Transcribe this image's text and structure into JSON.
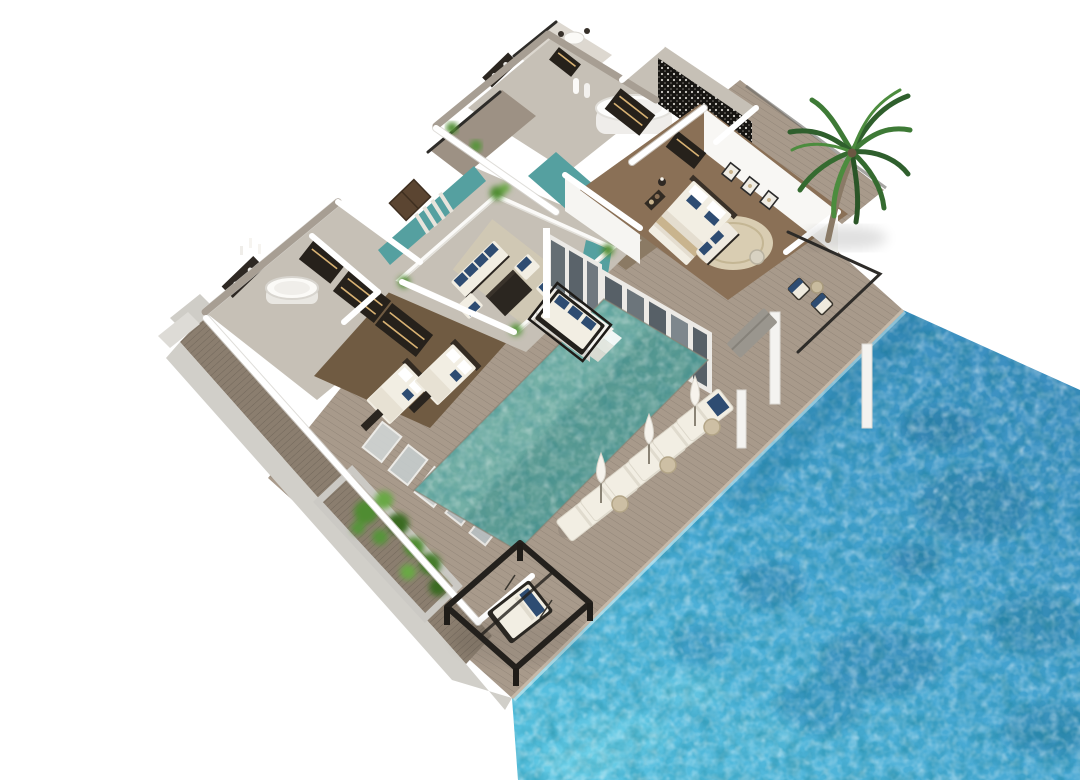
{
  "meta": {
    "image_type": "isometric 3D architectural floor-plan render",
    "subject": "two-storey beachfront villa with courtyard lounge, swimming pool, timber sun deck, cabana and ocean",
    "background": "#ffffff"
  },
  "palette": {
    "ocean_base": "#45a2cf",
    "ocean_deep": "#2e7ba6",
    "ocean_light": "#6fd0e8",
    "pool_base": "#5c9c94",
    "pool_light": "#8cc3b8",
    "moat_water": "#55a0a0",
    "deck_wood": "#a89a8b",
    "walkway_wood": "#8b7e6f",
    "concrete": "#d1cfc9",
    "wall_white": "#ffffff",
    "wall_shade": "#e9e8e4",
    "marble_wall": "#a79e93",
    "marble_floor": "#c6c0b6",
    "guest_floor": "#705b42",
    "master_floor": "#8a7056",
    "dining_floor": "#8b7a64",
    "rug": "#d9cdb2",
    "furniture_white": "#f2eee3",
    "cushion_navy": "#2e4c72",
    "dark_wood": "#26211b",
    "glass": "#4a545c",
    "metal_black": "#201d19",
    "palm_green": "#2f5f2d",
    "palm_light": "#4c8c3e",
    "shrub_green": "#4f8c31",
    "trunk_brown": "#8a7a66",
    "umbrella_white": "#f6f3ec",
    "door_brown": "#5b4531",
    "tan": "#c9b48e"
  },
  "inventory": {
    "sun_loungers": 6,
    "closed_umbrellas": 3,
    "side_tables": 3,
    "round_bathtubs": 2,
    "art_frames": 3,
    "bedrooms_visible": 2,
    "cabana_daybeds": 1,
    "pool_daybeds": 1,
    "palm_trees": 1
  }
}
